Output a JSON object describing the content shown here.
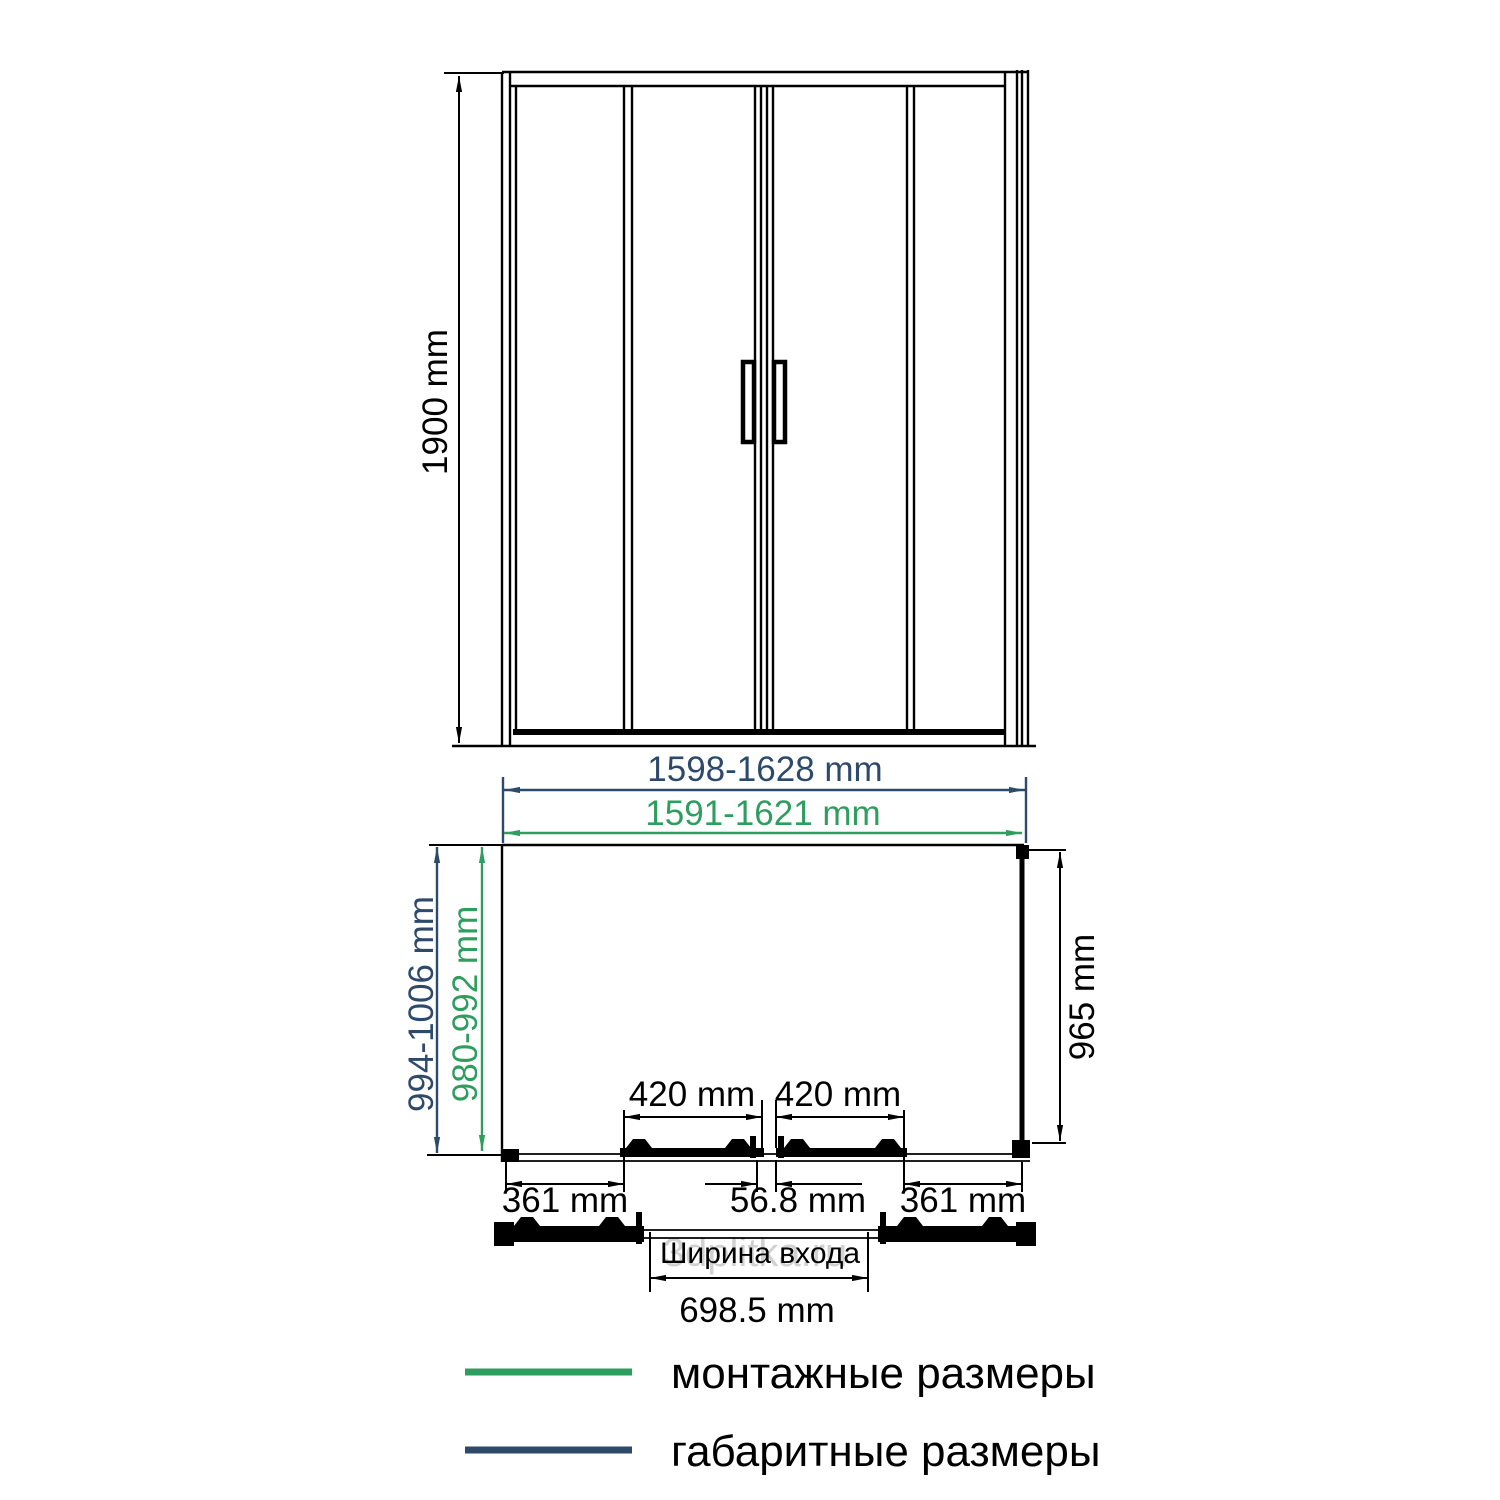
{
  "front_view": {
    "height": "1900 mm"
  },
  "plan_view": {
    "overall_width": "1598-1628 mm",
    "mounting_width": "1591-1621 mm",
    "overall_depth": "994-1006 mm",
    "mounting_depth": "980-992 mm",
    "inner_depth": "965 mm",
    "door_panel_left": "420 mm",
    "door_panel_right": "420 mm",
    "side_panel_left": "361 mm",
    "center_overlap": "56.8 mm",
    "side_panel_right": "361 mm",
    "entrance": {
      "label": "Ширина входа",
      "width": "698.5 mm"
    }
  },
  "legend": {
    "items": [
      {
        "label": "монтажные размеры",
        "color": "#2e9e5f"
      },
      {
        "label": "габаритные размеры",
        "color": "#2e4a6b"
      }
    ]
  },
  "watermark": {
    "text": "3dplitka.ru"
  },
  "colors": {
    "drawing": "#000000",
    "dimension_overall": "#2e4a6b",
    "dimension_mounting": "#2e9e5f",
    "watermark": "#c9c9c9",
    "background": "#ffffff"
  }
}
